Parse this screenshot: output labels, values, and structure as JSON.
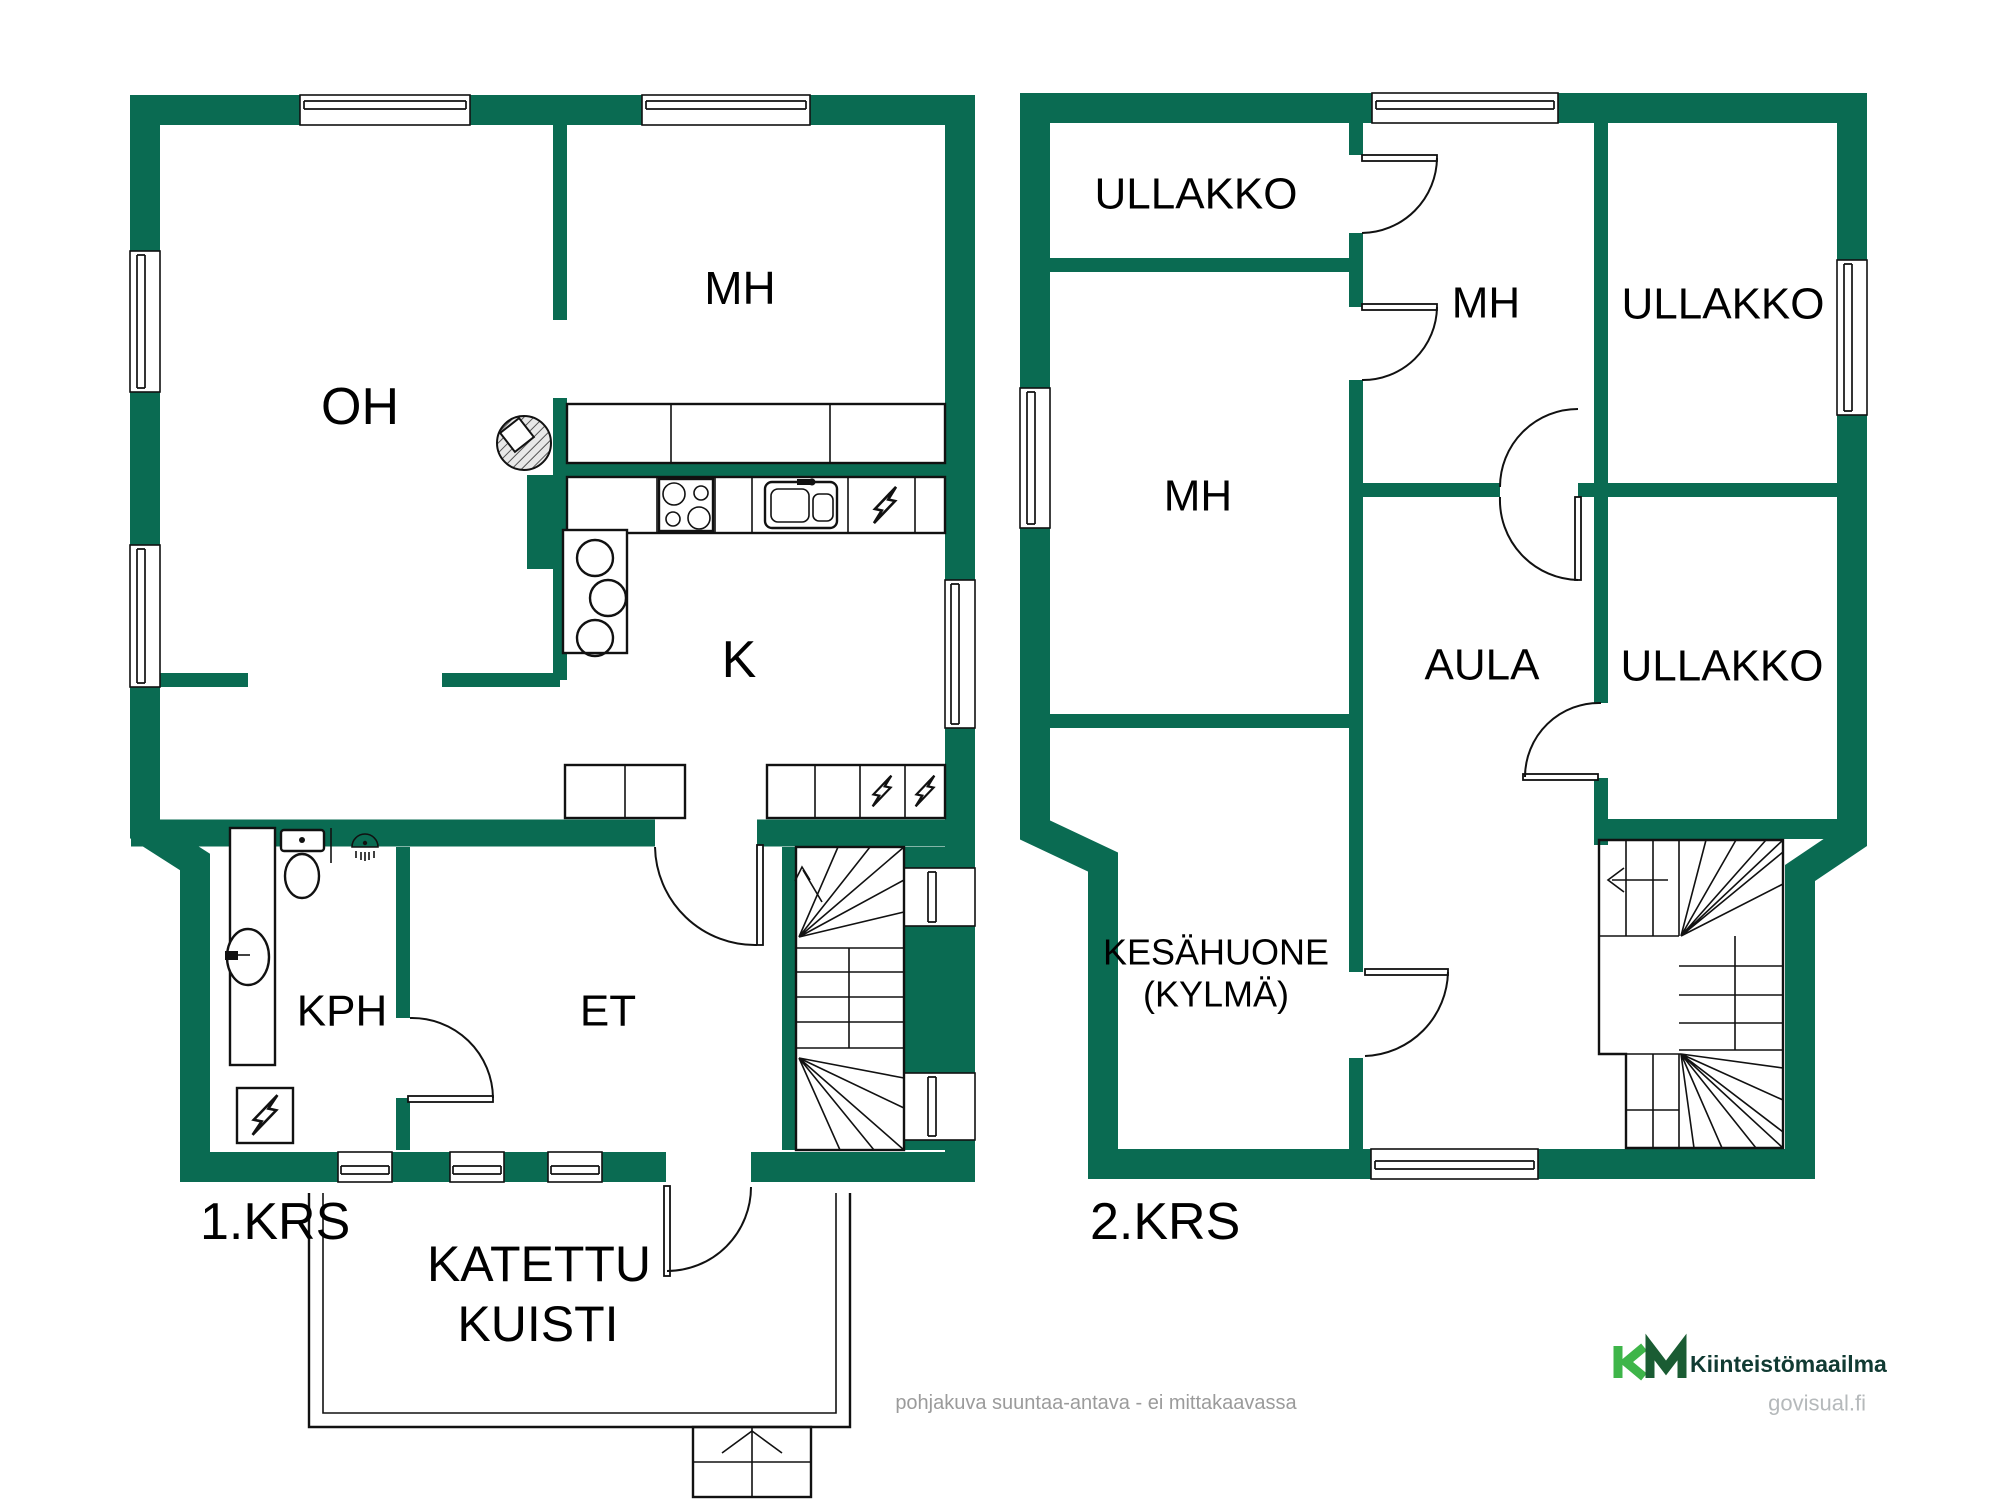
{
  "colors": {
    "wall": "#0a6b52",
    "line": "#111111",
    "text": "#000000",
    "muted": "#9b9b9b",
    "watermark": "#b5b9bb",
    "logo_light": "#3eb549",
    "logo_dark": "#1a5c33",
    "logo_text": "#113b33"
  },
  "floor1": {
    "name": "1.KRS",
    "rooms": [
      {
        "label": "OH"
      },
      {
        "label": "MH"
      },
      {
        "label": "K"
      },
      {
        "label": "KPH"
      },
      {
        "label": "ET"
      }
    ],
    "porch": {
      "label_line1": "KATETTU",
      "label_line2": "KUISTI"
    }
  },
  "floor2": {
    "name": "2.KRS",
    "rooms": [
      {
        "label": "ULLAKKO"
      },
      {
        "label": "MH"
      },
      {
        "label": "ULLAKKO"
      },
      {
        "label": "MH"
      },
      {
        "label": "AULA"
      },
      {
        "label": "ULLAKKO"
      },
      {
        "label": "KESÄHUONE",
        "label2": "(KYLMÄ)"
      }
    ]
  },
  "footer": {
    "disclaimer": "pohjakuva suuntaa-antava - ei mittakaavassa"
  },
  "logo": {
    "name": "Kiinteistömaailma",
    "site": "govisual.fi"
  }
}
